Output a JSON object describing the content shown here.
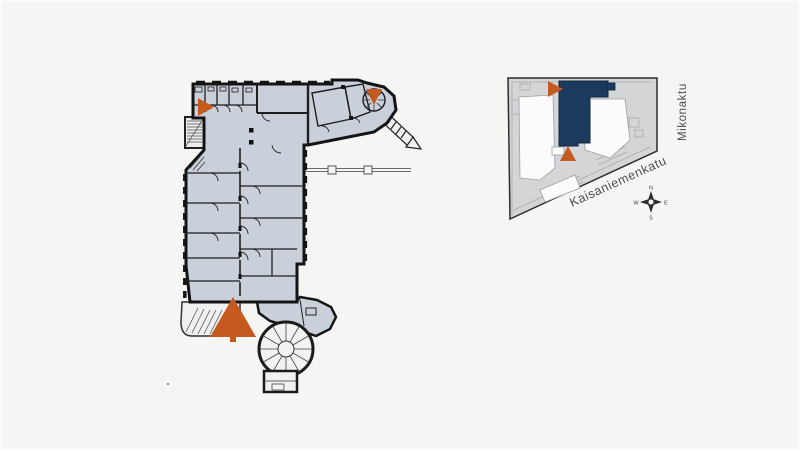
{
  "page": {
    "title": "Floor plan with location key map",
    "background": "#f5f5f4"
  },
  "colors": {
    "entrance": "#c6591f",
    "floor": "#c9d0d9",
    "wall": "#161616",
    "block": "#d4d5d7",
    "highlight": "#1c3a5e",
    "courtyard": "#fbfbfb"
  },
  "floor_plan": {
    "entrance_markers": [
      {
        "id": "entrance-top-left",
        "direction": "right"
      },
      {
        "id": "entrance-top-right",
        "direction": "down"
      },
      {
        "id": "entrance-main",
        "direction": "up"
      }
    ]
  },
  "key_map": {
    "street_right": "Mikonaktu",
    "street_bottom": "Kaisaniemenkatu",
    "compass": {
      "north": "N",
      "east": "E",
      "south": "S",
      "west": "W"
    }
  }
}
